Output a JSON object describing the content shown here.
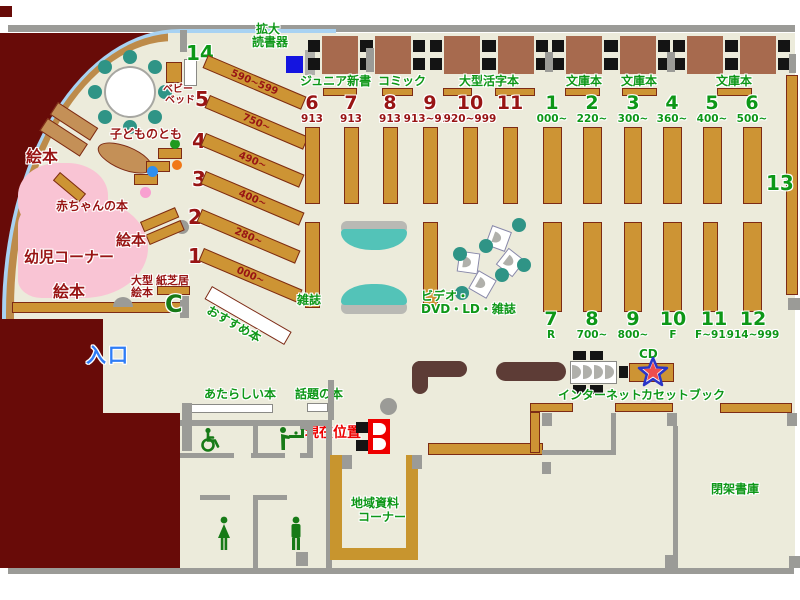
{
  "labels": {
    "kakudai_l1": "拡大",
    "kakudai_l2": "読書器",
    "junior_shinsho": "ジュニア新書",
    "comic": "コミック",
    "ogata_katsuji": "大型活字本",
    "bunko1": "文庫本",
    "bunko2": "文庫本",
    "bunko3": "文庫本",
    "zasshi": "雑誌",
    "video_l1": "ビデオ・",
    "video_l2": "DVD・LD・雑誌",
    "osusume": "おすすめ本",
    "atarashii": "あたらしい本",
    "wadai": "話題の本",
    "chiiki_l1": "地域資料",
    "chiiki_l2": "コーナー",
    "internet": "インターネット",
    "cassette": "カセットブック",
    "cd": "CD",
    "heika": "閉架書庫",
    "genzai": "現在位置",
    "iriguchi": "入口",
    "babybed_l1": "ベビー",
    "babybed_l2": "ベッド",
    "ehon_top": "絵本",
    "ehon_mid": "絵本",
    "ehon_bottom": "絵本",
    "kodomo_no_tomo": "子どものとも",
    "akachan_no_hon": "赤ちゃんの本",
    "yoji_corner": "幼児コーナー",
    "ogata_ehon_l1": "大型",
    "ogata_ehon_l2": "絵本",
    "kamishibai": "紙芝居"
  },
  "shelves": {
    "diagonal": [
      {
        "num": "14",
        "range": "590~599"
      },
      {
        "num": "5",
        "range": "750~"
      },
      {
        "num": "4",
        "range": "490~"
      },
      {
        "num": "3",
        "range": "400~"
      },
      {
        "num": "2",
        "range": "280~"
      },
      {
        "num": "1",
        "range": "000~"
      }
    ],
    "top_left": [
      {
        "num": "6",
        "range": "913"
      },
      {
        "num": "7",
        "range": "913"
      },
      {
        "num": "8",
        "range": "913"
      },
      {
        "num": "9",
        "range": "913~919"
      },
      {
        "num": "10",
        "range": "920~999"
      },
      {
        "num": "11",
        "range": ""
      }
    ],
    "top_right": [
      {
        "num": "1",
        "range": "000~"
      },
      {
        "num": "2",
        "range": "220~"
      },
      {
        "num": "3",
        "range": "300~"
      },
      {
        "num": "4",
        "range": "360~"
      },
      {
        "num": "5",
        "range": "400~"
      },
      {
        "num": "6",
        "range": "500~"
      }
    ],
    "bottom_right": [
      {
        "num": "7",
        "range": "R"
      },
      {
        "num": "8",
        "range": "700~"
      },
      {
        "num": "9",
        "range": "800~"
      },
      {
        "num": "10",
        "range": "F"
      },
      {
        "num": "11",
        "range": "F~914"
      },
      {
        "num": "12",
        "range": "914~999"
      }
    ],
    "right_wall": {
      "num": "13"
    }
  },
  "icons": {
    "phone_glyph": "C"
  },
  "colors": {
    "floor": "#ecebdb",
    "shelf_brown": "#cd9434",
    "outside_maroon": "#680b08",
    "wall_gray": "#9b9b97",
    "label_green": "#0d9717",
    "label_dark_red": "#981414",
    "entrance_blue": "#2f7df6",
    "current_pos_red": "#ec0000",
    "infant_pink": "#f9c4d4",
    "arc_light_blue": "#a8d2f2",
    "seat_teal": "#2f9486"
  }
}
